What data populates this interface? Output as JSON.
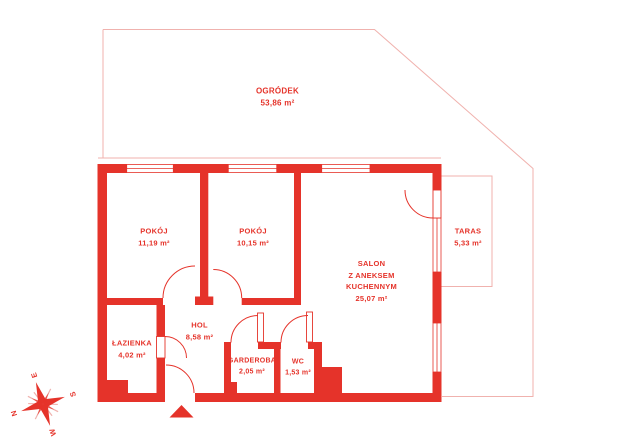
{
  "colors": {
    "wall": "#e5332a",
    "light_line": "#f0b2ae",
    "text": "#e5332a",
    "background": "#ffffff"
  },
  "rooms": {
    "ogrodek": {
      "name": "OGRÓDEK",
      "area": "53,86 m²"
    },
    "pokoj1": {
      "name": "POKÓJ",
      "area": "11,19 m²"
    },
    "pokoj2": {
      "name": "POKÓJ",
      "area": "10,15 m²"
    },
    "salon": {
      "line1": "SALON",
      "line2": "Z ANEKSEM",
      "line3": "KUCHENNYM",
      "area": "25,07 m²"
    },
    "taras": {
      "name": "TARAS",
      "area": "5,33 m²"
    },
    "lazienka": {
      "name": "ŁAZIENKA",
      "area": "4,02 m²"
    },
    "hol": {
      "name": "HOL",
      "area": "8,58 m²"
    },
    "garderoba": {
      "name": "GARDEROBA",
      "area": "2,05 m²"
    },
    "wc": {
      "name": "WC",
      "area": "1,53 m²"
    }
  },
  "compass": {
    "n": "N",
    "s": "S",
    "e": "E",
    "w": "W"
  }
}
